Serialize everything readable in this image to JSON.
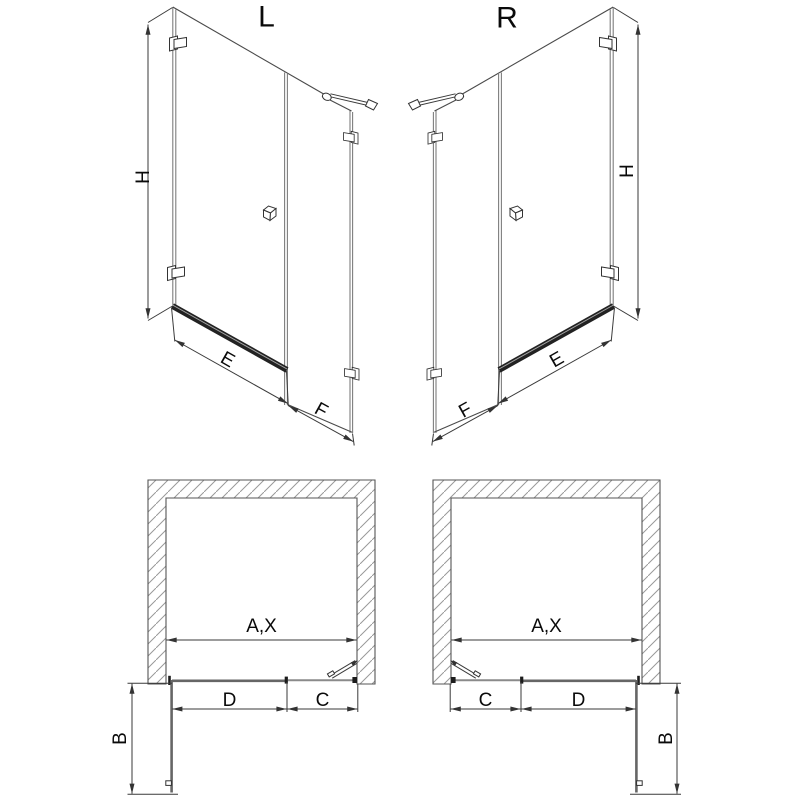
{
  "elevations": {
    "left": {
      "title": "L",
      "dims": {
        "height": "H",
        "door_width": "E",
        "fixed_panel_width": "F"
      }
    },
    "right": {
      "title": "R",
      "dims": {
        "height": "H",
        "door_width": "E",
        "fixed_panel_width": "F"
      }
    }
  },
  "plans": {
    "left": {
      "dims": {
        "opening_width": "A,X",
        "door_width": "D",
        "fixed_panel_width": "C",
        "door_projection": "B"
      }
    },
    "right": {
      "dims": {
        "opening_width": "A,X",
        "fixed_panel_width": "C",
        "door_width": "D",
        "door_projection": "B"
      }
    }
  },
  "colors": {
    "background": "#ffffff",
    "line": "#3a3a3a",
    "glass_edge": "#7d7d7d",
    "text": "#0a0a0a",
    "hatch": "#999999",
    "bottom_rail": "#222222"
  }
}
